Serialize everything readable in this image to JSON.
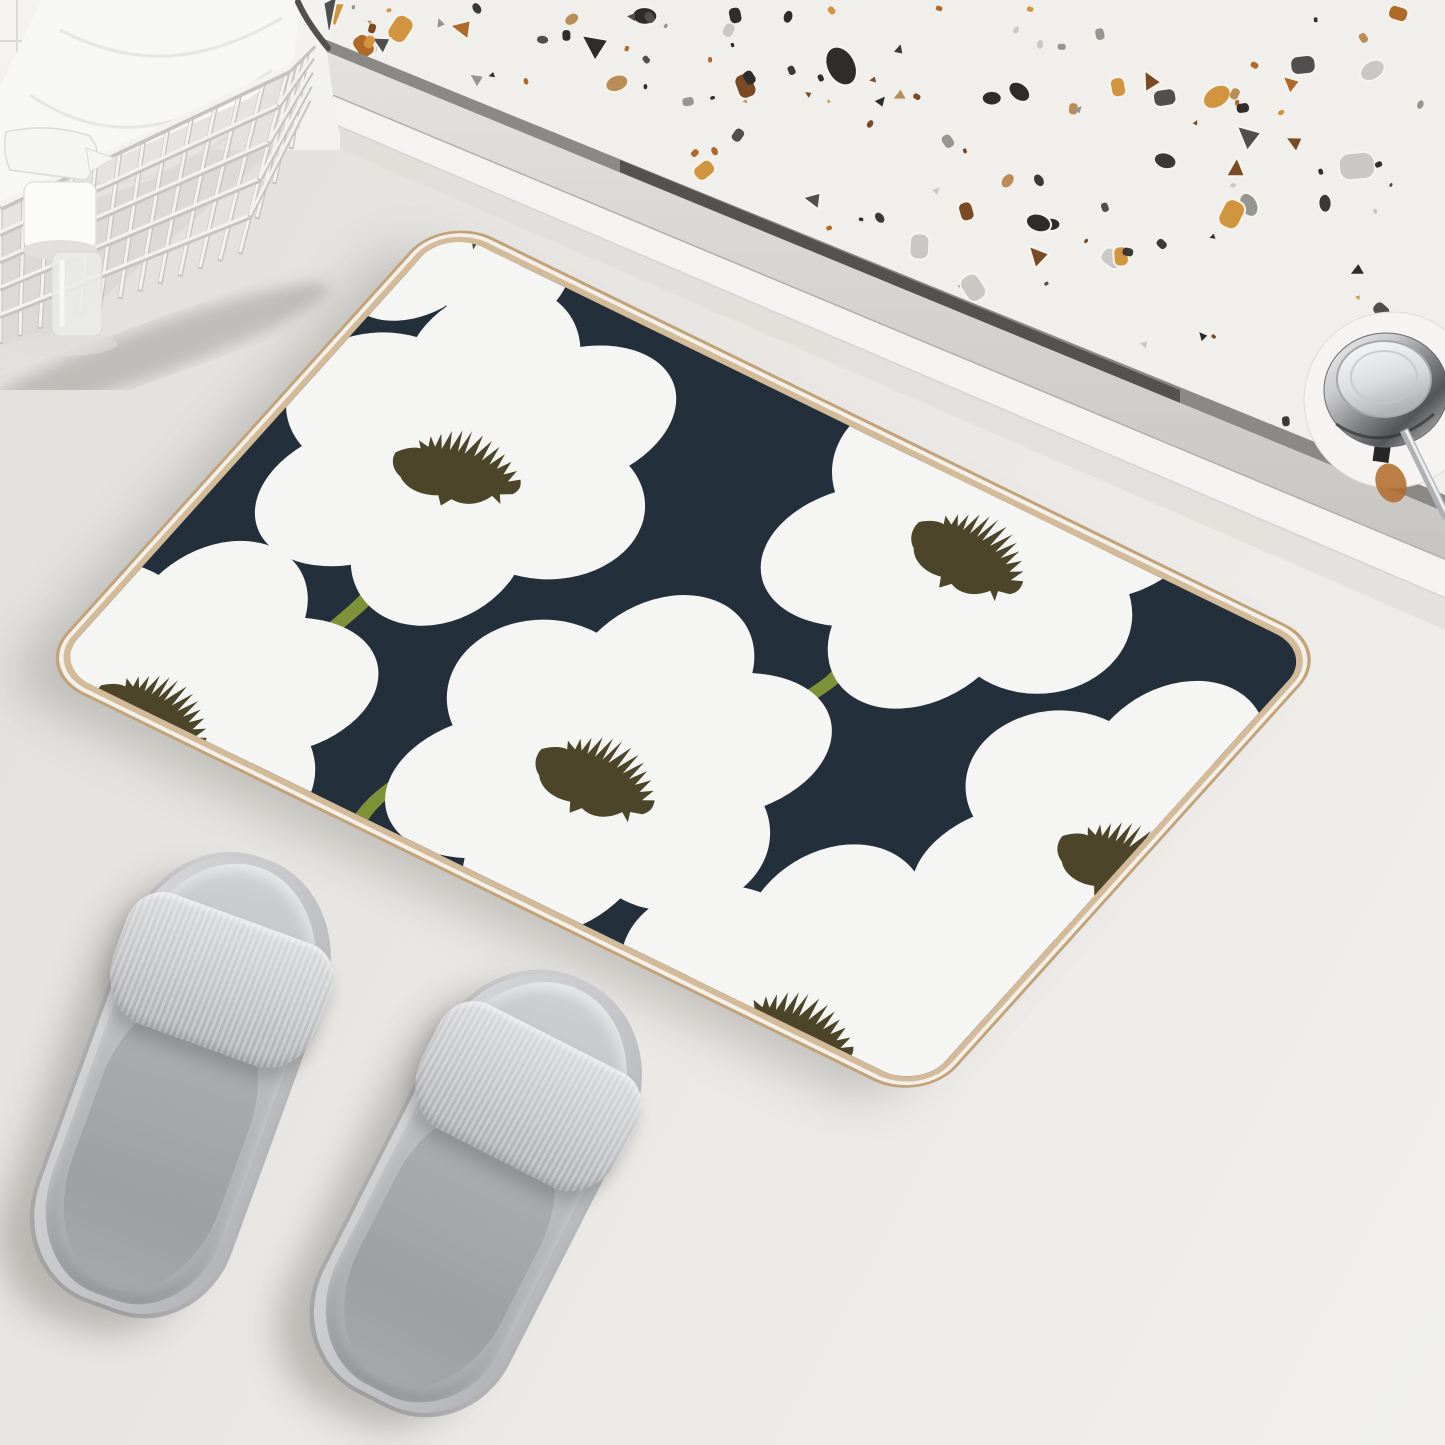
{
  "scene": {
    "description": "Product photo: floral bath mat on a light bathroom floor beside a glass shower rail with terrazzo surround; gray slide slippers in front, white wire basket with folded towel and toiletry bottles in the top-left corner, chrome shower-door roller at top right.",
    "objects": [
      "bath-mat",
      "slipper-left",
      "slipper-right",
      "wire-basket",
      "towel",
      "toiletry-bottles",
      "terrazzo-panel",
      "shower-door-rail",
      "shower-door-roller",
      "tiled-wall-corner"
    ]
  },
  "palette": {
    "floor_dark": "#e0dfdc",
    "floor_mid": "#e9e7e4",
    "floor_light": "#f1f0ed",
    "tile": "#f2f1ef",
    "grout": "#dbdad7",
    "terrazzo_base": "#f1efeb",
    "groove_light": "#8b8985",
    "groove_dark": "#464541",
    "sill_edge": "#b1afac",
    "rail_white": "#f4f3f1",
    "rail_under": "#cfccc7",
    "rail_shadow": "#e0deda",
    "mat_navy": "#232f3b",
    "petal": "#f5f5f3",
    "flower_center": "#4c4529",
    "stem": "#7e9238",
    "trim": "#d3bb99",
    "trim_outer": "#c2a278",
    "trim_gap": "#f3f0ea",
    "wire_light": "#f3f2f0",
    "wire_shadow": "#c5c4c1",
    "towel": "#f7f7f6",
    "towel_line": "#e4e3e0",
    "basket_interior": "#d7d6d3",
    "bottle": "#f5f5f3",
    "bottle_shadow": "#dfdedb",
    "knob_base": "#f5f4f2",
    "amber_reflection": "#b06a28",
    "shadow": "rgba(86,82,74,0.25)"
  },
  "terrazzo": {
    "seed": 12,
    "chip_count": 135,
    "chip_colors": [
      "#2e2d2b",
      "#2e2d2b",
      "#504f4d",
      "#97958f",
      "#c9c8c4",
      "#d2953f",
      "#b06a28",
      "#7b4a22",
      "#b98d55",
      "#3a3937"
    ]
  },
  "mat": {
    "pattern": "white poppy flowers with dark olive spiky centers and olive-green stems on navy",
    "flowers": [
      {
        "x": 170,
        "y": 190,
        "s": 0.93,
        "r": -10
      },
      {
        "x": 623,
        "y": 46,
        "s": 0.95,
        "r": 8
      },
      {
        "x": 491,
        "y": 400,
        "s": 0.96,
        "r": 3
      },
      {
        "x": 945,
        "y": 251,
        "s": 0.94,
        "r": 0
      },
      {
        "x": 810,
        "y": 540,
        "s": 0.96,
        "r": -6
      },
      {
        "x": 110,
        "y": 535,
        "s": 0.92,
        "r": 5
      },
      {
        "x": 5,
        "y": -35,
        "s": 0.72,
        "r": 20
      }
    ],
    "stems": [
      {
        "x": 185,
        "y": 330,
        "len": 1.1,
        "flip": false,
        "r": -6
      },
      {
        "x": 600,
        "y": 205,
        "len": 1.05,
        "flip": false,
        "r": 4
      },
      {
        "x": 870,
        "y": 368,
        "len": 1.25,
        "flip": true,
        "r": 8
      },
      {
        "x": 345,
        "y": 450,
        "len": 1.05,
        "flip": false,
        "r": 0
      }
    ]
  },
  "basket": {
    "verticals": 13,
    "horizontals": 5,
    "front_top": [
      [
        0,
        205
      ],
      [
        288,
        68
      ]
    ],
    "front_bottom": [
      [
        0,
        342
      ],
      [
        240,
        252
      ]
    ],
    "side_top": [
      [
        288,
        68
      ],
      [
        314,
        42
      ]
    ],
    "side_bottom": [
      [
        240,
        252
      ],
      [
        308,
        112
      ]
    ]
  }
}
